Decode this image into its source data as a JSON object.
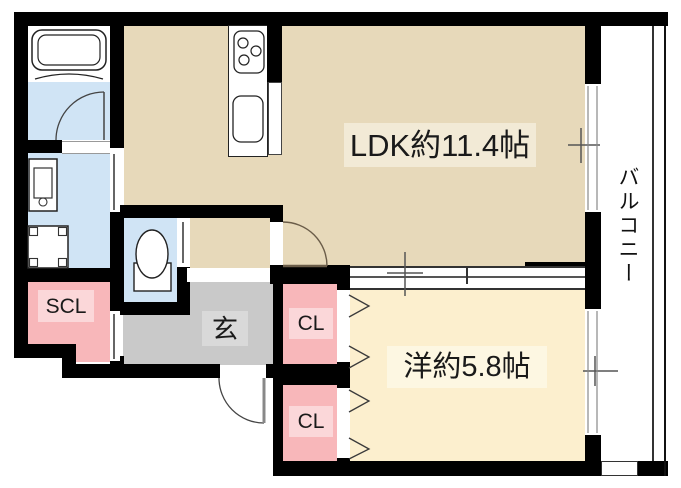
{
  "rooms": {
    "ldk": {
      "label": "LDK約11.4帖",
      "color": "#e7d9ba"
    },
    "western_room": {
      "label": "洋約5.8帖",
      "color": "#fcefce"
    },
    "balcony": {
      "label": "バルコニー",
      "color": "#ffffff"
    },
    "entrance": {
      "label": "玄",
      "color": "#c9c9c9"
    },
    "shoe_closet": {
      "label": "SCL",
      "color": "#f8b7ba"
    },
    "closet_upper": {
      "label": "CL",
      "color": "#f8b7ba"
    },
    "closet_lower": {
      "label": "CL",
      "color": "#f8b7ba"
    },
    "bathroom": {
      "color": "#d0e4f5"
    },
    "washroom": {
      "color": "#d0e4f5"
    },
    "toilet": {
      "color": "#d0e4f5"
    }
  },
  "colors": {
    "wall": "#000000",
    "background": "#ffffff",
    "label_bg_tan": "#f2ead6",
    "label_bg_cream": "#fdf7e2",
    "label_bg_pink": "#fbd7d9",
    "label_bg_gray": "#d9d9d9"
  },
  "fixtures": [
    "bathtub",
    "washing-machine",
    "vanity-sink",
    "toilet",
    "stove",
    "kitchen-sink"
  ]
}
